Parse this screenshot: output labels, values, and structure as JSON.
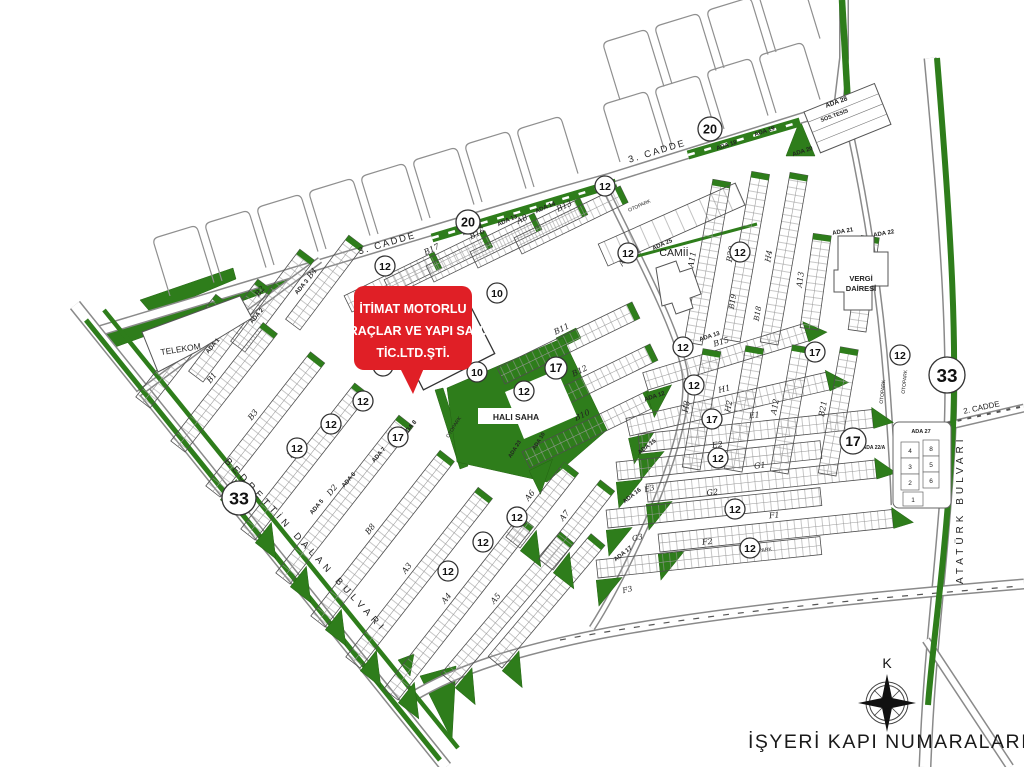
{
  "title": "İŞYERİ KAPI NUMARALARI",
  "compass": {
    "label": "K",
    "x": 887,
    "y": 703,
    "label_y": 668
  },
  "callout": {
    "lines": [
      "İTİMAT MOTORLU",
      "ARAÇLAR VE YAPI SAN.",
      "TİC.LTD.ŞTİ."
    ],
    "x": 354,
    "y": 286,
    "w": 118,
    "h": 84,
    "tail": [
      [
        400,
        368
      ],
      [
        424,
        368
      ],
      [
        413,
        394
      ]
    ],
    "line_ys": [
      313,
      335,
      357
    ]
  },
  "colors": {
    "green": "#2e7d1b",
    "green_dark": "#256414",
    "road_casing": "#8a8a8a",
    "street_casing": "#9a9a9a",
    "block_stroke": "#4d4d4d",
    "cell_line": "#999999",
    "red": "#e01f26",
    "text": "#1a1a1a",
    "label": "#222222"
  },
  "roads": [
    {
      "name": "cadde-3",
      "d": "M 92,333 L 560,192 L 610,178 L 840,106",
      "w": 11
    },
    {
      "name": "top-road",
      "d": "M 838,108 L 844,58 L 844,0",
      "w": 10
    },
    {
      "name": "ataturk-bulvari",
      "d": "M 930,58 C 946,230 956,360 948,465 C 941,575 929,655 925,767",
      "w": 13
    },
    {
      "name": "bedrettin-dalan",
      "d": "M 75,305 L 446,767",
      "w": 13
    },
    {
      "name": "bottom-road",
      "d": "M 412,697 C 460,668 520,650 600,634 C 700,615 850,598 1024,584",
      "w": 11
    },
    {
      "name": "cadde-2",
      "d": "M 930,430 L 1024,408",
      "w": 9
    },
    {
      "name": "bottom-right-road",
      "d": "M 926,640 L 1010,767",
      "w": 9
    },
    {
      "name": "telekom-street",
      "d": "M 138,394 L 320,260",
      "w": 7
    },
    {
      "name": "camii-street",
      "d": "M 602,182 C 648,275 676,330 684,368 C 692,405 670,470 648,520 C 630,560 610,600 592,628",
      "w": 7
    },
    {
      "name": "right-inner-street",
      "d": "M 845,108 C 868,210 882,310 888,400 C 891,445 893,470 894,505",
      "w": 7
    }
  ],
  "dash_roads": [
    {
      "name": "bottom-road-dashes",
      "d": "M 560,640 C 700,614 850,600 1020,586",
      "w": 1.2,
      "dash": "6,9"
    },
    {
      "name": "cadde-2-dashes",
      "d": "M 938,425 L 1020,407",
      "w": 2,
      "dash": "4,6"
    }
  ],
  "green_polys": [
    {
      "name": "cadde3-median-wedge",
      "pts": [
        [
          97,
          331
        ],
        [
          294,
          271
        ],
        [
          294,
          282
        ],
        [
          110,
          349
        ]
      ]
    },
    {
      "name": "telekom-north-wedge",
      "pts": [
        [
          140,
          300
        ],
        [
          233,
          268
        ],
        [
          236,
          279
        ],
        [
          152,
          314
        ]
      ]
    },
    {
      "name": "ada20-triangle",
      "pts": [
        [
          786,
          156
        ],
        [
          800,
          120
        ],
        [
          815,
          156
        ]
      ]
    },
    {
      "name": "fork-triangle",
      "pts": [
        [
          420,
          676
        ],
        [
          456,
          666
        ],
        [
          452,
          740
        ]
      ]
    },
    {
      "name": "fork-triangle-small",
      "pts": [
        [
          398,
          660
        ],
        [
          414,
          654
        ],
        [
          410,
          676
        ]
      ]
    },
    {
      "name": "halisaha-west-strip",
      "pts": [
        [
          435,
          390
        ],
        [
          443,
          388
        ],
        [
          468,
          466
        ],
        [
          460,
          469
        ]
      ]
    },
    {
      "name": "green-plot-small",
      "pts": [
        [
          556,
          338
        ],
        [
          576,
          328
        ],
        [
          581,
          338
        ],
        [
          561,
          348
        ]
      ]
    },
    {
      "name": "halisaha-field",
      "pts": [
        [
          447,
          388
        ],
        [
          563,
          338
        ],
        [
          607,
          430
        ],
        [
          547,
          482
        ],
        [
          457,
          462
        ]
      ]
    }
  ],
  "white_polys": [
    {
      "name": "halisaha-inner",
      "pts": [
        [
          505,
          392
        ],
        [
          557,
          370
        ],
        [
          577,
          416
        ],
        [
          524,
          439
        ]
      ]
    }
  ],
  "green_lines": [
    {
      "name": "median-1",
      "d": "M 432,238 L 616,183",
      "w": 9,
      "dash_white": true
    },
    {
      "name": "median-2",
      "d": "M 688,155 L 800,122",
      "w": 9,
      "dash_white": true
    },
    {
      "name": "median-thin",
      "d": "M 630,258 L 757,224",
      "w": 3,
      "dash_white": false
    },
    {
      "name": "bulvar-strip-1",
      "d": "M 86,320 L 440,760",
      "w": 5,
      "dash_white": false
    },
    {
      "name": "bulvar-strip-2",
      "d": "M 104,310 L 458,748",
      "w": 4.5,
      "dash_white": false
    },
    {
      "name": "ataturk-strip",
      "d": "M 937,58 C 951,230 959,355 951,462 C 944,570 932,650 928,705",
      "w": 6,
      "dash_white": false
    },
    {
      "name": "top-road-strip",
      "d": "M 842,0 L 848,105",
      "w": 6.5,
      "dash_white": false
    }
  ],
  "combs": [
    {
      "x": 170,
      "y": 296,
      "a": -17
    },
    {
      "x": 222,
      "y": 281,
      "a": -17
    },
    {
      "x": 274,
      "y": 265,
      "a": -17
    },
    {
      "x": 326,
      "y": 249,
      "a": -17
    },
    {
      "x": 378,
      "y": 234,
      "a": -17
    },
    {
      "x": 430,
      "y": 218,
      "a": -17
    },
    {
      "x": 482,
      "y": 202,
      "a": -17
    },
    {
      "x": 534,
      "y": 187,
      "a": -17
    },
    {
      "x": 620,
      "y": 162,
      "a": -17
    },
    {
      "x": 672,
      "y": 146,
      "a": -17
    },
    {
      "x": 724,
      "y": 129,
      "a": -17
    },
    {
      "x": 776,
      "y": 113,
      "a": -17
    },
    {
      "x": 620,
      "y": 100,
      "a": -17
    },
    {
      "x": 672,
      "y": 84,
      "a": -17
    },
    {
      "x": 724,
      "y": 68,
      "a": -17
    },
    {
      "x": 776,
      "y": 52,
      "a": -17
    }
  ],
  "rows": [
    {
      "x": 203,
      "y": 382,
      "a": -53,
      "l": 115,
      "t": "C2",
      "c": "S"
    },
    {
      "x": 245,
      "y": 352,
      "a": -53,
      "l": 115,
      "t": "B2",
      "c": "S"
    },
    {
      "x": 300,
      "y": 330,
      "a": -53,
      "l": 105,
      "t": "B4",
      "c": "S"
    },
    {
      "x": 150,
      "y": 408,
      "a": -52,
      "l": 130,
      "t": "C1",
      "c": "S"
    },
    {
      "x": 185,
      "y": 452,
      "a": -52,
      "l": 150,
      "t": "B1",
      "c": "S"
    },
    {
      "x": 220,
      "y": 497,
      "a": -52,
      "l": 170,
      "t": "B3",
      "c": "TS"
    },
    {
      "x": 255,
      "y": 540,
      "a": -52,
      "l": 185,
      "t": "D1",
      "c": "TS"
    },
    {
      "x": 290,
      "y": 584,
      "a": -52,
      "l": 200,
      "t": "D2",
      "c": "TS"
    },
    {
      "x": 325,
      "y": 627,
      "a": -52,
      "l": 210,
      "t": "B8",
      "c": "TS"
    },
    {
      "x": 360,
      "y": 668,
      "a": -52,
      "l": 215,
      "t": "A3",
      "c": "TS"
    },
    {
      "x": 398,
      "y": 700,
      "a": -52,
      "l": 220,
      "t": "A4",
      "c": "TS"
    },
    {
      "x": 455,
      "y": 685,
      "a": -50,
      "l": 185,
      "t": "A5",
      "c": "TS"
    },
    {
      "x": 502,
      "y": 668,
      "a": -50,
      "l": 160,
      "t": "",
      "c": "TS"
    },
    {
      "x": 352,
      "y": 312,
      "a": -26,
      "l": 100,
      "t": "B14",
      "c": "S"
    },
    {
      "x": 392,
      "y": 296,
      "a": -26,
      "l": 112,
      "t": "B17",
      "c": "S"
    },
    {
      "x": 434,
      "y": 282,
      "a": -26,
      "l": 120,
      "t": "B16",
      "c": "S"
    },
    {
      "x": 478,
      "y": 268,
      "a": -26,
      "l": 122,
      "t": "A8",
      "c": "S"
    },
    {
      "x": 522,
      "y": 254,
      "a": -26,
      "l": 118,
      "t": "B13",
      "c": "S"
    },
    {
      "x": 505,
      "y": 384,
      "a": -26,
      "l": 150,
      "t": "B11",
      "c": "S"
    },
    {
      "x": 523,
      "y": 426,
      "a": -26,
      "l": 150,
      "t": "B12",
      "c": "S"
    },
    {
      "x": 530,
      "y": 468,
      "a": -26,
      "l": 140,
      "t": "B10",
      "c": "TS"
    },
    {
      "x": 520,
      "y": 548,
      "a": -52,
      "l": 95,
      "t": "A6",
      "c": "TS"
    },
    {
      "x": 553,
      "y": 570,
      "a": -52,
      "l": 100,
      "t": "A7",
      "c": "TS"
    },
    {
      "x": 648,
      "y": 390,
      "a": -17,
      "l": 168,
      "t": "B15",
      "c": "TE"
    },
    {
      "x": 630,
      "y": 436,
      "a": -13,
      "l": 205,
      "t": "H1",
      "c": "TE"
    },
    {
      "x": 640,
      "y": 452,
      "a": -6,
      "l": 235,
      "t": "E1",
      "c": "TE"
    },
    {
      "x": 618,
      "y": 480,
      "a": -6,
      "l": 205,
      "t": "E2",
      "c": "T"
    },
    {
      "x": 648,
      "y": 502,
      "a": -6,
      "l": 230,
      "t": "G1",
      "c": "TE"
    },
    {
      "x": 608,
      "y": 528,
      "a": -6,
      "l": 215,
      "t": "G2",
      "c": "T"
    },
    {
      "x": 660,
      "y": 552,
      "a": -6,
      "l": 235,
      "t": "F1",
      "c": "TE"
    },
    {
      "x": 598,
      "y": 578,
      "a": -6,
      "l": 225,
      "t": "F2",
      "c": "T"
    },
    {
      "x": 702,
      "y": 345,
      "a": -80,
      "l": 165,
      "t": "A11",
      "c": "S"
    },
    {
      "x": 740,
      "y": 342,
      "a": -80,
      "l": 170,
      "t": "B20",
      "c": "S"
    },
    {
      "x": 778,
      "y": 345,
      "a": -80,
      "l": 172,
      "t": "H4",
      "c": "S"
    },
    {
      "x": 818,
      "y": 330,
      "a": -82,
      "l": 95,
      "t": "A13",
      "c": "S"
    },
    {
      "x": 866,
      "y": 332,
      "a": -82,
      "l": 95,
      "t": "B22",
      "c": "S"
    },
    {
      "x": 700,
      "y": 470,
      "a": -80,
      "l": 120,
      "t": "H3",
      "c": "S"
    },
    {
      "x": 742,
      "y": 472,
      "a": -80,
      "l": 125,
      "t": "H2",
      "c": "S"
    },
    {
      "x": 788,
      "y": 474,
      "a": -80,
      "l": 128,
      "t": "A12",
      "c": "S"
    },
    {
      "x": 836,
      "y": 476,
      "a": -80,
      "l": 128,
      "t": "B21",
      "c": "S"
    },
    {
      "x": 608,
      "y": 266,
      "a": -24,
      "l": 150,
      "t": "",
      "c": "N",
      "h": 24
    }
  ],
  "labels": [
    {
      "t": "3. CADDE",
      "x": 388,
      "y": 246,
      "r": -16.5,
      "s": 9.5,
      "ls": 2
    },
    {
      "t": "3. CADDE",
      "x": 658,
      "y": 154,
      "r": -17,
      "s": 9.5,
      "ls": 2
    },
    {
      "t": "2. CADDE",
      "x": 982,
      "y": 410,
      "r": -12,
      "s": 8
    },
    {
      "t": "TELEKOM",
      "x": 181,
      "y": 352,
      "r": -9,
      "s": 8.5
    },
    {
      "t": "CAMİİ",
      "x": 674,
      "y": 256,
      "r": 0,
      "s": 10.5
    },
    {
      "t": "VERGİ",
      "x": 861,
      "y": 281,
      "r": 0,
      "s": 7.5,
      "b": true
    },
    {
      "t": "DAİRESİ",
      "x": 861,
      "y": 291,
      "r": 0,
      "s": 7.5,
      "b": true
    },
    {
      "t": "HALI SAHA",
      "x": 516,
      "y": 420,
      "r": 0,
      "s": 8.5,
      "b": true
    },
    {
      "t": "ADA 1",
      "x": 214,
      "y": 347,
      "r": -50,
      "s": 6,
      "b": true
    },
    {
      "t": "ADA 2",
      "x": 258,
      "y": 317,
      "r": -50,
      "s": 6,
      "b": true
    },
    {
      "t": "ADA 3",
      "x": 303,
      "y": 288,
      "r": -50,
      "s": 6,
      "b": true
    },
    {
      "t": "ADA 5",
      "x": 318,
      "y": 508,
      "r": -50,
      "s": 6,
      "b": true
    },
    {
      "t": "ADA 6",
      "x": 350,
      "y": 481,
      "r": -50,
      "s": 6,
      "b": true
    },
    {
      "t": "ADA 7",
      "x": 380,
      "y": 456,
      "r": -50,
      "s": 6,
      "b": true
    },
    {
      "t": "ADA 8",
      "x": 411,
      "y": 429,
      "r": -50,
      "s": 6,
      "b": true
    },
    {
      "t": "ADA 12",
      "x": 473,
      "y": 231,
      "r": -24,
      "s": 6,
      "b": true
    },
    {
      "t": "ADA 13",
      "x": 508,
      "y": 222,
      "r": -24,
      "s": 6,
      "b": true
    },
    {
      "t": "ADA 14",
      "x": 546,
      "y": 209,
      "r": -24,
      "s": 6,
      "b": true
    },
    {
      "t": "ADA 23",
      "x": 516,
      "y": 450,
      "r": -58,
      "s": 5.5,
      "b": true
    },
    {
      "t": "ADA 10",
      "x": 540,
      "y": 442,
      "r": -58,
      "s": 5.5,
      "b": true
    },
    {
      "t": "ADA 13",
      "x": 710,
      "y": 338,
      "r": -18,
      "s": 6,
      "b": true
    },
    {
      "t": "ADA 12",
      "x": 655,
      "y": 398,
      "r": -18,
      "s": 6,
      "b": true
    },
    {
      "t": "ADA 15",
      "x": 648,
      "y": 448,
      "r": -38,
      "s": 6,
      "b": true
    },
    {
      "t": "ADA 16",
      "x": 633,
      "y": 497,
      "r": -38,
      "s": 6,
      "b": true
    },
    {
      "t": "ADA 17",
      "x": 624,
      "y": 555,
      "r": -38,
      "s": 6,
      "b": true
    },
    {
      "t": "ADA 18",
      "x": 727,
      "y": 147,
      "r": -18,
      "s": 6,
      "b": true
    },
    {
      "t": "ADA 19",
      "x": 765,
      "y": 133,
      "r": -18,
      "s": 6,
      "b": true
    },
    {
      "t": "ADA 20",
      "x": 803,
      "y": 153,
      "r": -18,
      "s": 6,
      "b": true
    },
    {
      "t": "ADA 21",
      "x": 843,
      "y": 233,
      "r": -10,
      "s": 6,
      "b": true
    },
    {
      "t": "ADA 22",
      "x": 884,
      "y": 235,
      "r": -10,
      "s": 6,
      "b": true
    },
    {
      "t": "ADA 25",
      "x": 663,
      "y": 246,
      "r": -24,
      "s": 6,
      "b": true
    },
    {
      "t": "ADA 27",
      "x": 921,
      "y": 433,
      "r": 0,
      "s": 5.5,
      "b": true
    },
    {
      "t": "ADA 28",
      "x": 837,
      "y": 104,
      "r": -20,
      "s": 6.5,
      "b": true
    },
    {
      "t": "SOS.TESİS",
      "x": 835,
      "y": 117,
      "r": -20,
      "s": 5.5,
      "b": true
    },
    {
      "t": "ADA 22/A",
      "x": 874,
      "y": 449,
      "r": 0,
      "s": 5,
      "b": true
    },
    {
      "t": "E3",
      "x": 650,
      "y": 491,
      "r": -14,
      "s": 7.5,
      "i": true
    },
    {
      "t": "G3",
      "x": 638,
      "y": 540,
      "r": -14,
      "s": 7.5,
      "i": true
    },
    {
      "t": "F3",
      "x": 628,
      "y": 592,
      "r": -14,
      "s": 7.5,
      "i": true
    },
    {
      "t": "A9",
      "x": 625,
      "y": 262,
      "r": -60,
      "s": 7.5,
      "i": true
    },
    {
      "t": "B19",
      "x": 735,
      "y": 302,
      "r": -80,
      "s": 7.5,
      "i": true
    },
    {
      "t": "B18",
      "x": 760,
      "y": 314,
      "r": -80,
      "s": 7.5,
      "i": true
    },
    {
      "t": "OTOPARK",
      "x": 455,
      "y": 428,
      "r": -58,
      "s": 5
    },
    {
      "t": "OTOPARK",
      "x": 640,
      "y": 207,
      "r": -24,
      "s": 5
    },
    {
      "t": "OTOPARK",
      "x": 906,
      "y": 382,
      "r": -84,
      "s": 5
    },
    {
      "t": "OTOPARK",
      "x": 884,
      "y": 392,
      "r": -84,
      "s": 5
    },
    {
      "t": "OTOPARK",
      "x": 760,
      "y": 552,
      "r": -7,
      "s": 5
    }
  ],
  "curved_road_labels": [
    {
      "t": "BEDRETTİN DALAN BULVARI",
      "path_d": "M 112,340 L 486,745",
      "offset": "30%",
      "s": 9.5,
      "ls": 4.5
    },
    {
      "t": "ATATÜRK BULVARI",
      "x": 963,
      "y": 584,
      "r": -90,
      "s": 10,
      "ls": 4
    }
  ],
  "badges": [
    {
      "t": "20",
      "x": 468,
      "y": 222,
      "rad": 12
    },
    {
      "t": "20",
      "x": 710,
      "y": 129,
      "rad": 12
    },
    {
      "t": "33",
      "x": 239,
      "y": 498,
      "rad": 17
    },
    {
      "t": "33",
      "x": 947,
      "y": 375,
      "rad": 18
    },
    {
      "t": "17",
      "x": 398,
      "y": 437,
      "rad": 10
    },
    {
      "t": "17",
      "x": 556,
      "y": 368,
      "rad": 11
    },
    {
      "t": "17",
      "x": 815,
      "y": 352,
      "rad": 10
    },
    {
      "t": "17",
      "x": 712,
      "y": 419,
      "rad": 10
    },
    {
      "t": "17",
      "x": 853,
      "y": 441,
      "rad": 13
    },
    {
      "t": "12",
      "x": 385,
      "y": 266,
      "rad": 10
    },
    {
      "t": "12",
      "x": 605,
      "y": 186,
      "rad": 10
    },
    {
      "t": "12",
      "x": 628,
      "y": 253,
      "rad": 10
    },
    {
      "t": "12",
      "x": 740,
      "y": 252,
      "rad": 10
    },
    {
      "t": "12",
      "x": 683,
      "y": 347,
      "rad": 10
    },
    {
      "t": "12",
      "x": 694,
      "y": 385,
      "rad": 10
    },
    {
      "t": "12",
      "x": 900,
      "y": 355,
      "rad": 10
    },
    {
      "t": "12",
      "x": 524,
      "y": 391,
      "rad": 10
    },
    {
      "t": "12",
      "x": 363,
      "y": 401,
      "rad": 10
    },
    {
      "t": "12",
      "x": 331,
      "y": 424,
      "rad": 10
    },
    {
      "t": "12",
      "x": 297,
      "y": 448,
      "rad": 10
    },
    {
      "t": "12",
      "x": 517,
      "y": 517,
      "rad": 10
    },
    {
      "t": "12",
      "x": 483,
      "y": 542,
      "rad": 10
    },
    {
      "t": "12",
      "x": 448,
      "y": 571,
      "rad": 10
    },
    {
      "t": "12",
      "x": 718,
      "y": 458,
      "rad": 10
    },
    {
      "t": "12",
      "x": 735,
      "y": 509,
      "rad": 10
    },
    {
      "t": "12",
      "x": 750,
      "y": 548,
      "rad": 10
    },
    {
      "t": "10",
      "x": 383,
      "y": 366,
      "rad": 10
    },
    {
      "t": "10",
      "x": 477,
      "y": 372,
      "rad": 10
    },
    {
      "t": "10",
      "x": 497,
      "y": 293,
      "rad": 10
    }
  ],
  "buildings": [
    {
      "name": "telekom-block",
      "d": "M 142,332 L 240,296 L 252,318 L 196,352 L 158,372 Z"
    },
    {
      "name": "vergi-dairesi",
      "d": "M 838,236 h36 v16 h14 v34 h-16 v24 h-28 v-18 h-10 v-22 h4 Z"
    },
    {
      "name": "camii-building",
      "d": "M 656,268 l 20,-7 4,11 12,-4 9,26 -11,4 3,10 -17,6 -4,-11 -10,3 Z"
    }
  ],
  "ada28": {
    "x": 804,
    "y": 112,
    "rot": -22,
    "w": 76,
    "h": 44,
    "cells": 4
  },
  "ada27": {
    "outer": {
      "x": 893,
      "y": 422,
      "w": 58,
      "h": 86
    },
    "left_cells": [
      "4",
      "3",
      "2"
    ],
    "right_cells": [
      "8",
      "5",
      "6"
    ],
    "bottom_cell": "1",
    "lx": 901,
    "rx": 923,
    "cy0": 442,
    "ch": 16,
    "cw": 18,
    "rcw": 16,
    "bx": 903,
    "by": 492,
    "bw": 20,
    "bh": 14
  },
  "itimat_block": {
    "x": 398,
    "y": 340,
    "rot": -27,
    "w": 80,
    "h": 56
  }
}
